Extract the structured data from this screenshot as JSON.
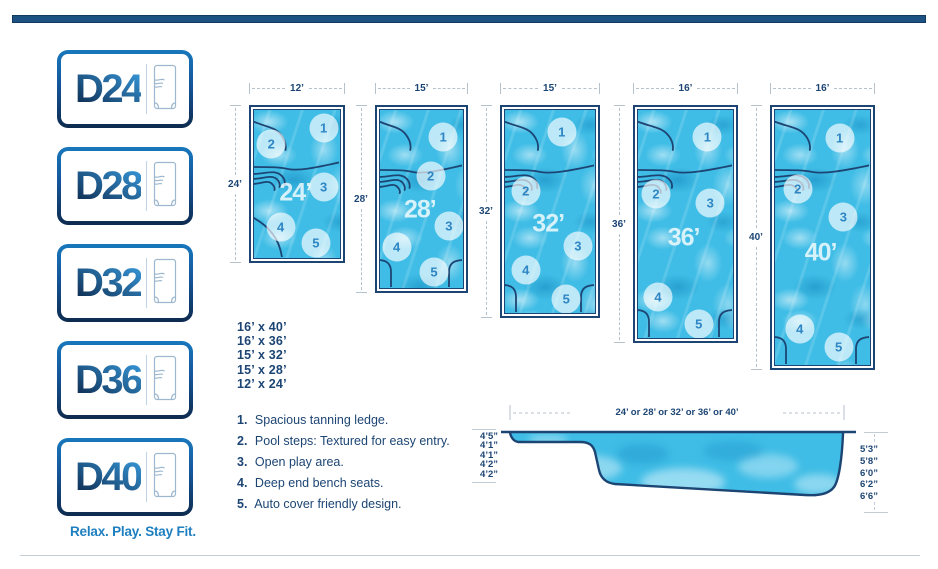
{
  "colors": {
    "navy": "#1c4574",
    "navy_dark": "#0e2f55",
    "accent_blue": "#1e7fc0",
    "water": "#3fbde6",
    "dim_gray": "#b5c2cc"
  },
  "sidebar": {
    "models": [
      {
        "label": "D24"
      },
      {
        "label": "D28"
      },
      {
        "label": "D32"
      },
      {
        "label": "D36"
      },
      {
        "label": "D40"
      }
    ],
    "tagline": "Relax. Play. Stay Fit."
  },
  "pools": [
    {
      "model": "D24",
      "width_label": "12’",
      "length_label": "24’",
      "center_label": "24’",
      "width_ft": 12,
      "length_ft": 24,
      "left_px": 249,
      "width_px": 96,
      "height_px": 158,
      "cluster_y": 52,
      "bottom_style": "sweep",
      "markers": [
        {
          "n": "1",
          "x": 81,
          "y": 12
        },
        {
          "n": "2",
          "x": 20,
          "y": 23
        },
        {
          "n": "3",
          "x": 81,
          "y": 52
        },
        {
          "n": "4",
          "x": 31,
          "y": 79
        },
        {
          "n": "5",
          "x": 72,
          "y": 90
        }
      ]
    },
    {
      "model": "D28",
      "width_label": "15’",
      "length_label": "28’",
      "center_label": "28’",
      "width_ft": 15,
      "length_ft": 28,
      "left_px": 375,
      "width_px": 93,
      "height_px": 188,
      "cluster_y": 55,
      "bottom_style": "tabs",
      "markers": [
        {
          "n": "1",
          "x": 76,
          "y": 15
        },
        {
          "n": "2",
          "x": 61,
          "y": 37
        },
        {
          "n": "3",
          "x": 83,
          "y": 65
        },
        {
          "n": "4",
          "x": 20,
          "y": 77
        },
        {
          "n": "5",
          "x": 65,
          "y": 91
        }
      ]
    },
    {
      "model": "D32",
      "width_label": "15’",
      "length_label": "32’",
      "center_label": "32’",
      "width_ft": 15,
      "length_ft": 32,
      "left_px": 500,
      "width_px": 100,
      "height_px": 213,
      "cluster_y": 55,
      "bottom_style": "tabs",
      "markers": [
        {
          "n": "1",
          "x": 63,
          "y": 11
        },
        {
          "n": "2",
          "x": 23,
          "y": 40
        },
        {
          "n": "3",
          "x": 81,
          "y": 67
        },
        {
          "n": "4",
          "x": 23,
          "y": 79
        },
        {
          "n": "5",
          "x": 68,
          "y": 93
        }
      ]
    },
    {
      "model": "D36",
      "width_label": "16’",
      "length_label": "36’",
      "center_label": "36’",
      "width_ft": 16,
      "length_ft": 36,
      "left_px": 633,
      "width_px": 105,
      "height_px": 238,
      "cluster_y": 55,
      "bottom_style": "tabs",
      "markers": [
        {
          "n": "1",
          "x": 73,
          "y": 12
        },
        {
          "n": "2",
          "x": 19,
          "y": 37
        },
        {
          "n": "3",
          "x": 76,
          "y": 41
        },
        {
          "n": "4",
          "x": 21,
          "y": 82
        },
        {
          "n": "5",
          "x": 64,
          "y": 94
        }
      ]
    },
    {
      "model": "D40",
      "width_label": "16’",
      "length_label": "40’",
      "center_label": "40’",
      "width_ft": 16,
      "length_ft": 40,
      "left_px": 770,
      "width_px": 105,
      "height_px": 265,
      "cluster_y": 55,
      "bottom_style": "tabs",
      "markers": [
        {
          "n": "1",
          "x": 68,
          "y": 11
        },
        {
          "n": "2",
          "x": 24,
          "y": 31
        },
        {
          "n": "3",
          "x": 72,
          "y": 42
        },
        {
          "n": "4",
          "x": 26,
          "y": 86
        },
        {
          "n": "5",
          "x": 67,
          "y": 93
        }
      ]
    }
  ],
  "sizes_list": [
    "16’ x 40’",
    "16’ x 36’",
    "15’ x 32’",
    "15’ x 28’",
    "12’ x 24’"
  ],
  "features": [
    {
      "num": "1.",
      "text": "Spacious tanning ledge."
    },
    {
      "num": "2.",
      "text": "Pool steps: Textured for easy entry."
    },
    {
      "num": "3.",
      "text": "Open play area."
    },
    {
      "num": "4.",
      "text": "Deep end bench seats."
    },
    {
      "num": "5.",
      "text": "Auto cover friendly design."
    }
  ],
  "profile": {
    "length_label": "24’ or 28’ or 32’ or 36’ or 40’",
    "left_depths": [
      "4’5”",
      "4’1”",
      "4’1”",
      "4’2”",
      "4’2”"
    ],
    "right_depths": [
      "5’3”",
      "5’8”",
      "6’0”",
      "6’2”",
      "6’6”"
    ]
  }
}
